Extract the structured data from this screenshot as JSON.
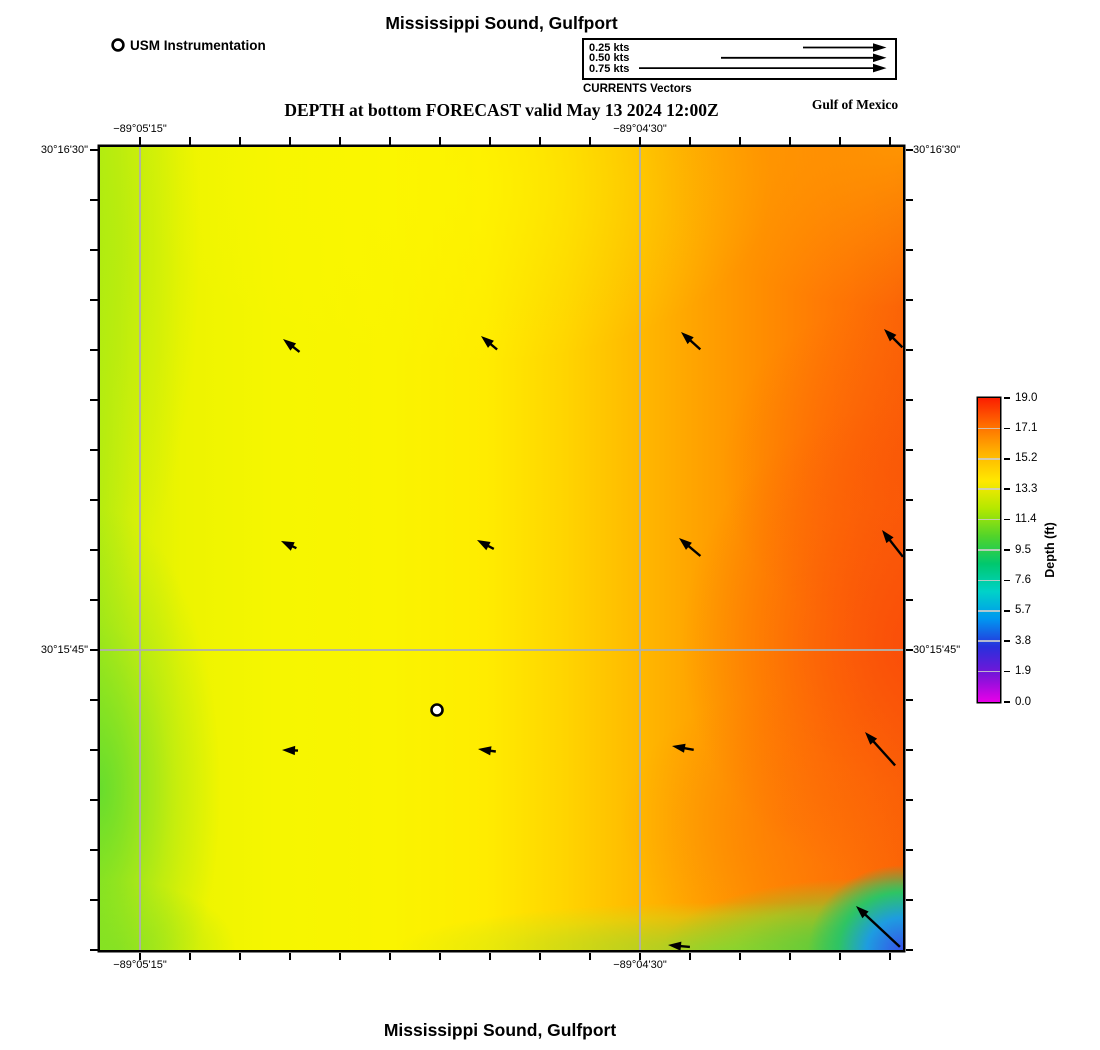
{
  "header": {
    "title": "Mississippi Sound, Gulfport",
    "instrument_legend": "USM Instrumentation",
    "vector_legend": {
      "caption": "CURRENTS Vectors",
      "rows": [
        {
          "label": "0.25 kts",
          "tail_x": 219
        },
        {
          "label": "0.50 kts",
          "tail_x": 137
        },
        {
          "label": "0.75 kts",
          "tail_x": 55
        }
      ]
    },
    "subtitle": "DEPTH at bottom FORECAST valid May 13 2024 12:00Z",
    "region_label": "Gulf of Mexico"
  },
  "footer": {
    "title": "Mississippi Sound, Gulfport"
  },
  "chart_data": {
    "type": "heatmap",
    "title": "Mississippi Sound, Gulfport",
    "subtitle": "DEPTH at bottom FORECAST valid May 13 2024 12:00Z",
    "region": "Gulf of Mexico",
    "grid": true,
    "x_ticks": [
      {
        "label": "−89°05'15\"",
        "frac": 0.0498
      },
      {
        "label": "−89°04'30\"",
        "frac": 0.6725
      }
    ],
    "y_ticks": [
      {
        "label": "30°16'30\"",
        "frac": 0.004
      },
      {
        "label": "30°15'45\"",
        "frac": 0.6264
      }
    ],
    "frame_ticks": {
      "x_start": 40,
      "x_step": 50,
      "x_count": 16,
      "y_start": 3,
      "y_step": 50,
      "y_count": 17
    },
    "colorbar": {
      "label": "Depth (ft)",
      "min": 0.0,
      "max": 19.0,
      "tick_values": [
        19.0,
        17.1,
        15.2,
        13.3,
        11.4,
        9.5,
        7.6,
        5.7,
        3.8,
        1.9,
        0.0
      ],
      "colors_top_to_bottom": [
        "#fb1e00",
        "#ff6e00",
        "#ffb400",
        "#ffe800",
        "#b4e800",
        "#52d42a",
        "#00c86e",
        "#00d2c8",
        "#0096f0",
        "#2830dc",
        "#7814d8",
        "#e800e8"
      ]
    },
    "depth_field_description": "Depth ~13-15 ft (yellow-green) along the west side grading eastward to 17-19 ft (orange-red); shallow 2-8 ft (blue-cyan) pocket in the extreme southeast corner with a 10-13 ft green band along the southeast bottom edge",
    "station": {
      "name": "USM Instrumentation",
      "x_px": 337,
      "y_px": 563
    },
    "legend_speeds_kts": [
      0.25,
      0.5,
      0.75
    ],
    "vectors_px": [
      {
        "x": 183,
        "y": 192,
        "dir": 142,
        "len": 21
      },
      {
        "x": 381,
        "y": 189,
        "dir": 140,
        "len": 21
      },
      {
        "x": 581,
        "y": 185,
        "dir": 138,
        "len": 26
      },
      {
        "x": 784,
        "y": 182,
        "dir": 135,
        "len": 26
      },
      {
        "x": 181,
        "y": 394,
        "dir": 155,
        "len": 17
      },
      {
        "x": 377,
        "y": 393,
        "dir": 152,
        "len": 19
      },
      {
        "x": 579,
        "y": 391,
        "dir": 140,
        "len": 28
      },
      {
        "x": 782,
        "y": 383,
        "dir": 128,
        "len": 34
      },
      {
        "x": 182,
        "y": 603,
        "dir": 178,
        "len": 16
      },
      {
        "x": 378,
        "y": 602,
        "dir": 172,
        "len": 18
      },
      {
        "x": 572,
        "y": 599,
        "dir": 170,
        "len": 22
      },
      {
        "x": 765,
        "y": 585,
        "dir": 132,
        "len": 45
      },
      {
        "x": 568,
        "y": 798,
        "dir": 175,
        "len": 22
      },
      {
        "x": 756,
        "y": 759,
        "dir": 137,
        "len": 60
      }
    ]
  }
}
